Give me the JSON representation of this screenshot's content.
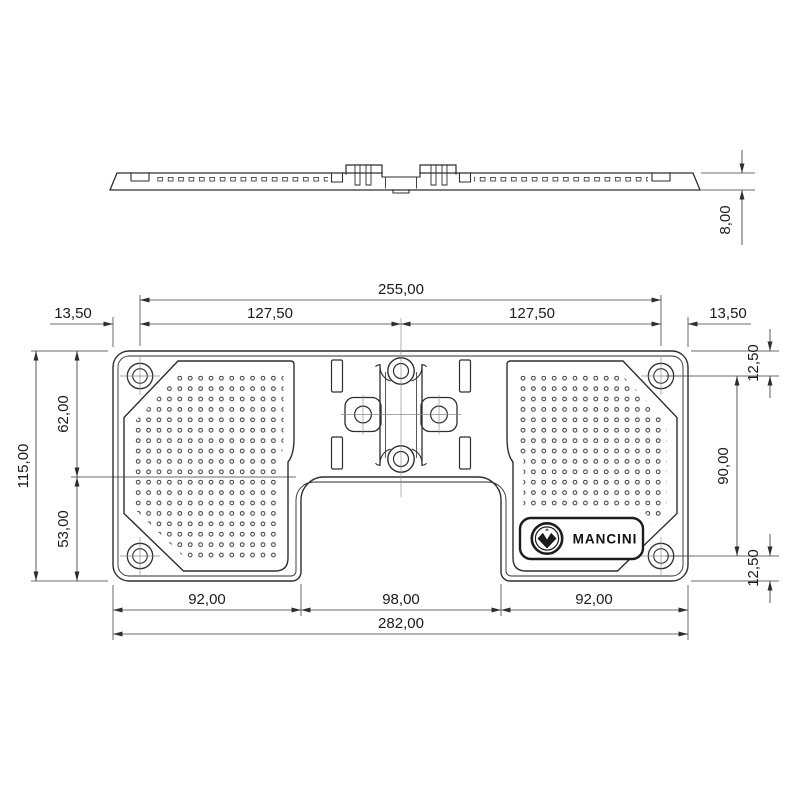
{
  "drawing": {
    "brand": "MANCINI",
    "side_view": {
      "thickness": "8,00"
    },
    "plan_view": {
      "top_dims": {
        "hole_span": "255,00",
        "left_half": "127,50",
        "right_half": "127,50",
        "left_edge": "13,50",
        "right_edge": "13,50"
      },
      "left_dims": {
        "height": "115,00",
        "upper": "62,00",
        "lower": "53,00"
      },
      "right_dims": {
        "top_offset": "12,50",
        "hole_span": "90,00",
        "bottom_offset": "12,50"
      },
      "bottom_dims": {
        "left_pad": "92,00",
        "notch": "98,00",
        "right_pad": "92,00",
        "width": "282,00"
      }
    }
  }
}
